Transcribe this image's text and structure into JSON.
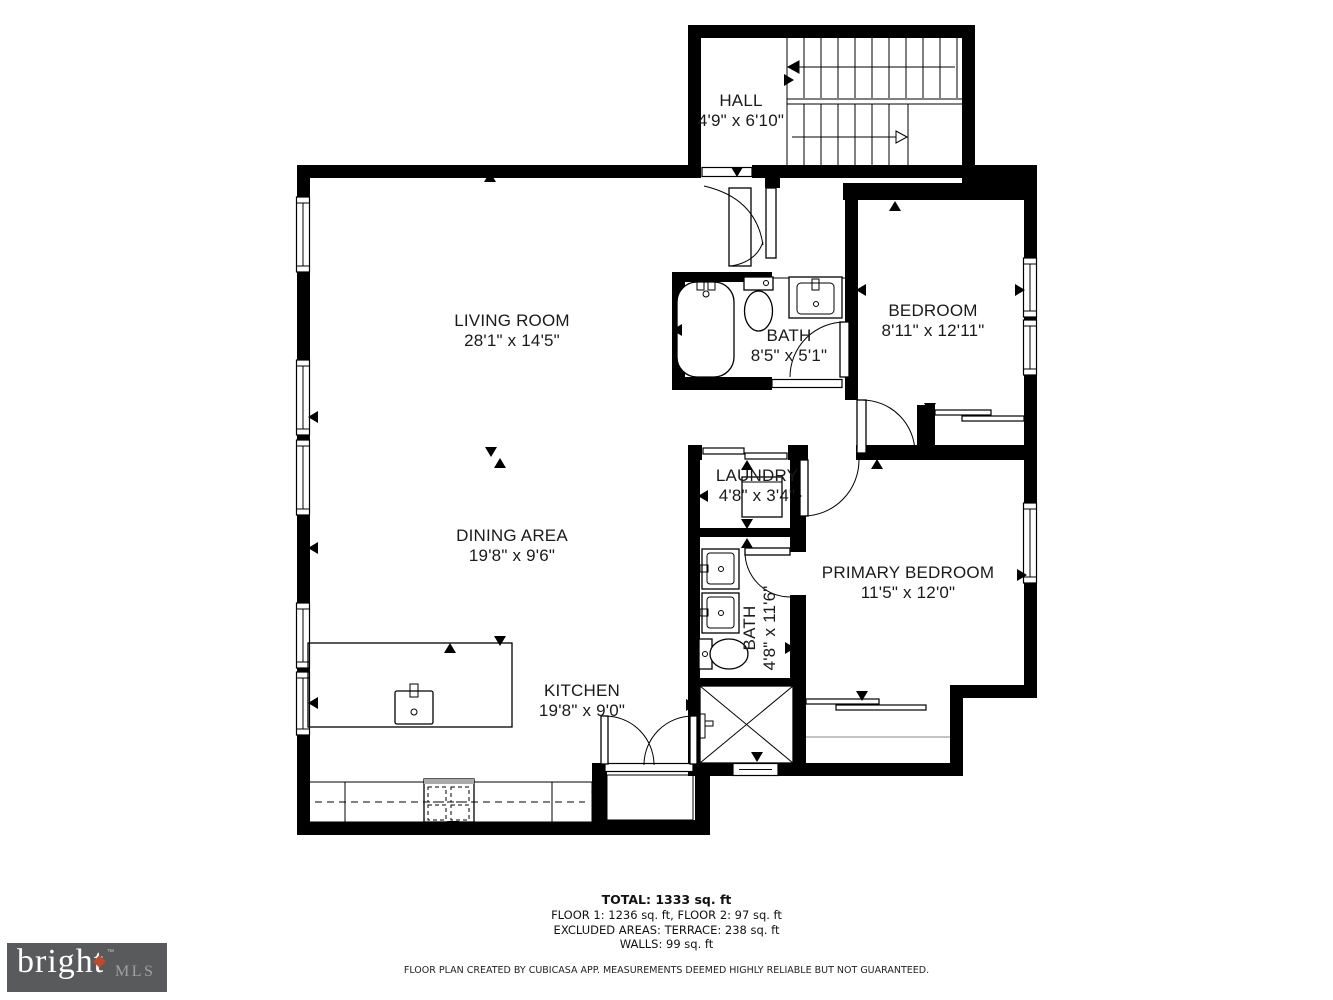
{
  "plan": {
    "rooms": [
      {
        "id": "hall",
        "name": "HALL",
        "dims": "4'9\" x 6'10\""
      },
      {
        "id": "living-room",
        "name": "LIVING ROOM",
        "dims": "28'1\" x 14'5\""
      },
      {
        "id": "bedroom",
        "name": "BEDROOM",
        "dims": "8'11\" x 12'11\""
      },
      {
        "id": "bath-upper",
        "name": "BATH",
        "dims": "8'5\" x 5'1\""
      },
      {
        "id": "laundry",
        "name": "LAUNDRY",
        "dims": "4'8\" x 3'4\""
      },
      {
        "id": "dining-area",
        "name": "DINING AREA",
        "dims": "19'8\" x 9'6\""
      },
      {
        "id": "primary-bedroom",
        "name": "PRIMARY BEDROOM",
        "dims": "11'5\" x 12'0\""
      },
      {
        "id": "bath-lower",
        "name": "BATH",
        "dims": "4'8\" x 11'6\""
      },
      {
        "id": "kitchen",
        "name": "KITCHEN",
        "dims": "19'8\" x 9'0\""
      }
    ],
    "fixtures": [
      "stairs",
      "bathtub",
      "toilet",
      "sink",
      "washer",
      "kitchen-island",
      "island-sink",
      "stove",
      "counter",
      "shower",
      "closet-sliding-doors"
    ]
  },
  "summary": {
    "total": "TOTAL: 1333 sq. ft",
    "floors": "FLOOR 1: 1236 sq. ft, FLOOR 2: 97 sq. ft",
    "excluded": "EXCLUDED AREAS: TERRACE: 238 sq. ft",
    "walls": "WALLS: 99 sq. ft"
  },
  "disclaimer": "FLOOR PLAN CREATED BY CUBICASA APP. MEASUREMENTS DEEMED HIGHLY RELIABLE BUT NOT GUARANTEED.",
  "logo": {
    "brand": "bright",
    "suffix": "MLS",
    "tm": "™"
  },
  "colors": {
    "wall": "#000000",
    "background": "#FFFFFF",
    "logo_bg": "#595A5C",
    "logo_text": "#FFFFFF",
    "logo_diamond": "#C1492E",
    "logo_mls": "#A0A0A0"
  }
}
